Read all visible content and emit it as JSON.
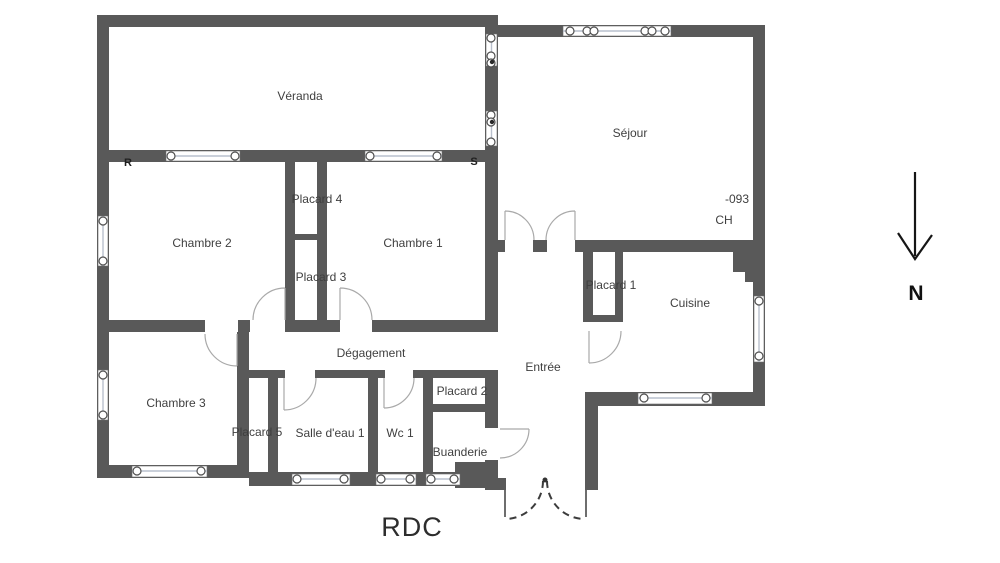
{
  "plan": {
    "floor_title": "RDC",
    "rooms": {
      "veranda": "Véranda",
      "sejour": "Séjour",
      "chambre1": "Chambre 1",
      "chambre2": "Chambre 2",
      "chambre3": "Chambre 3",
      "placard1": "Placard 1",
      "placard2": "Placard 2",
      "placard3": "Placard 3",
      "placard4": "Placard 4",
      "placard5": "Placard 5",
      "degagement": "Dégagement",
      "entree": "Entrée",
      "salle_deau1": "Salle d'eau 1",
      "wc1": "Wc 1",
      "buanderie": "Buanderie",
      "cuisine": "Cuisine"
    },
    "annotations": {
      "ref_number": "-093",
      "ch": "CH",
      "mark_r": "R",
      "mark_s": "S"
    },
    "compass": {
      "north_label": "N"
    }
  },
  "colors": {
    "wall": "#595959",
    "background": "#ffffff",
    "window_line": "#b9c0cd",
    "door_arc": "#a9a9a9",
    "dashed_door": "#3c3c3c",
    "text": "#3f3f3f"
  }
}
